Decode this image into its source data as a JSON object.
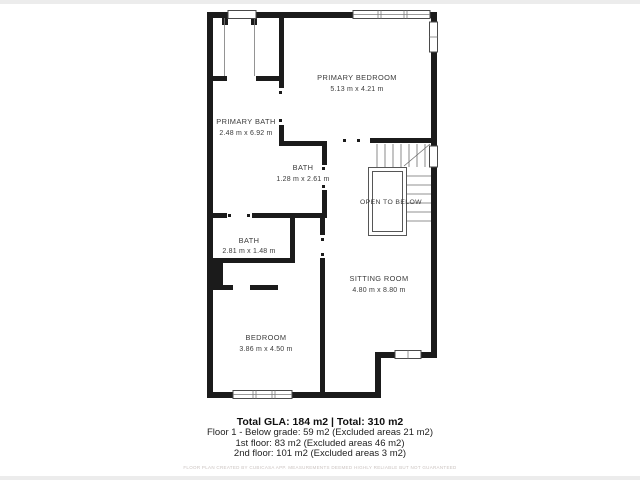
{
  "plan": {
    "wall_color": "#1b1b1b",
    "rooms": {
      "primary_bedroom": {
        "name": "PRIMARY BEDROOM",
        "dims": "5.13 m x 4.21 m"
      },
      "primary_bath": {
        "name": "PRIMARY BATH",
        "dims": "2.48 m x 6.92 m"
      },
      "bath_small": {
        "name": "BATH",
        "dims": "1.28 m x 2.61 m"
      },
      "bath_lower": {
        "name": "BATH",
        "dims": "2.81 m x 1.48 m"
      },
      "bedroom": {
        "name": "BEDROOM",
        "dims": "3.86 m x 4.50 m"
      },
      "sitting_room": {
        "name": "SITTING ROOM",
        "dims": "4.80 m x 8.80 m"
      },
      "open_to_below": {
        "name": "OPEN TO BELOW"
      }
    }
  },
  "footer": {
    "total_line": "Total GLA: 184 m2 | Total: 310 m2",
    "lines": [
      "Floor 1 - Below grade: 59 m2 (Excluded areas 21 m2)",
      "1st floor: 83 m2 (Excluded areas 46 m2)",
      "2nd floor: 101 m2 (Excluded areas 3 m2)"
    ],
    "disclaimer": "FLOOR PLAN CREATED BY CUBICASA APP. MEASUREMENTS DEEMED HIGHLY RELIABLE BUT NOT GUARANTEED"
  }
}
